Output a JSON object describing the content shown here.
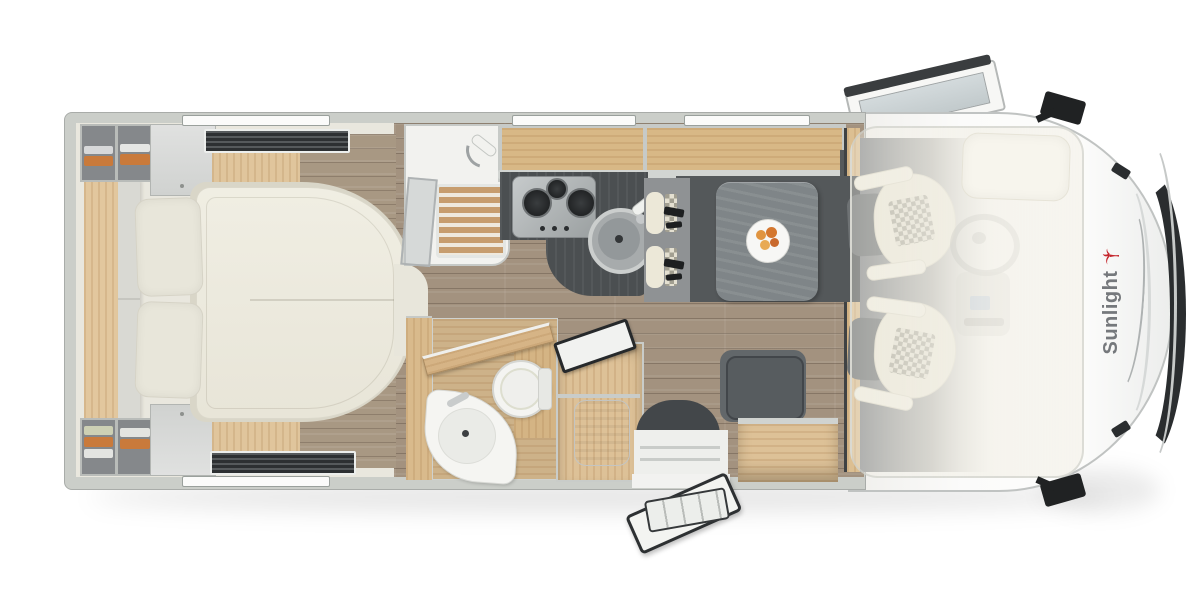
{
  "brand": {
    "name": "Sunlight"
  },
  "view": "motorhome-top-down-floorplan",
  "areas": [
    "bedroom",
    "wardrobes",
    "shower",
    "kitchen",
    "bathroom",
    "dinette",
    "entry-door",
    "cab",
    "drop-down-bed"
  ],
  "colors": {
    "red": "#c4242b",
    "wall": "#cbcec9",
    "cream": "#e9e7de",
    "floor": "#a3927f",
    "wood": "#ddc197",
    "counter": "#4b4f51",
    "table": "#7f8588",
    "seat": "#5b6062",
    "upholstery": "#ece8d8",
    "nose": "#fbfbfa",
    "glassDark": "#2a2d2f",
    "fixture": "#f4f4f1"
  }
}
